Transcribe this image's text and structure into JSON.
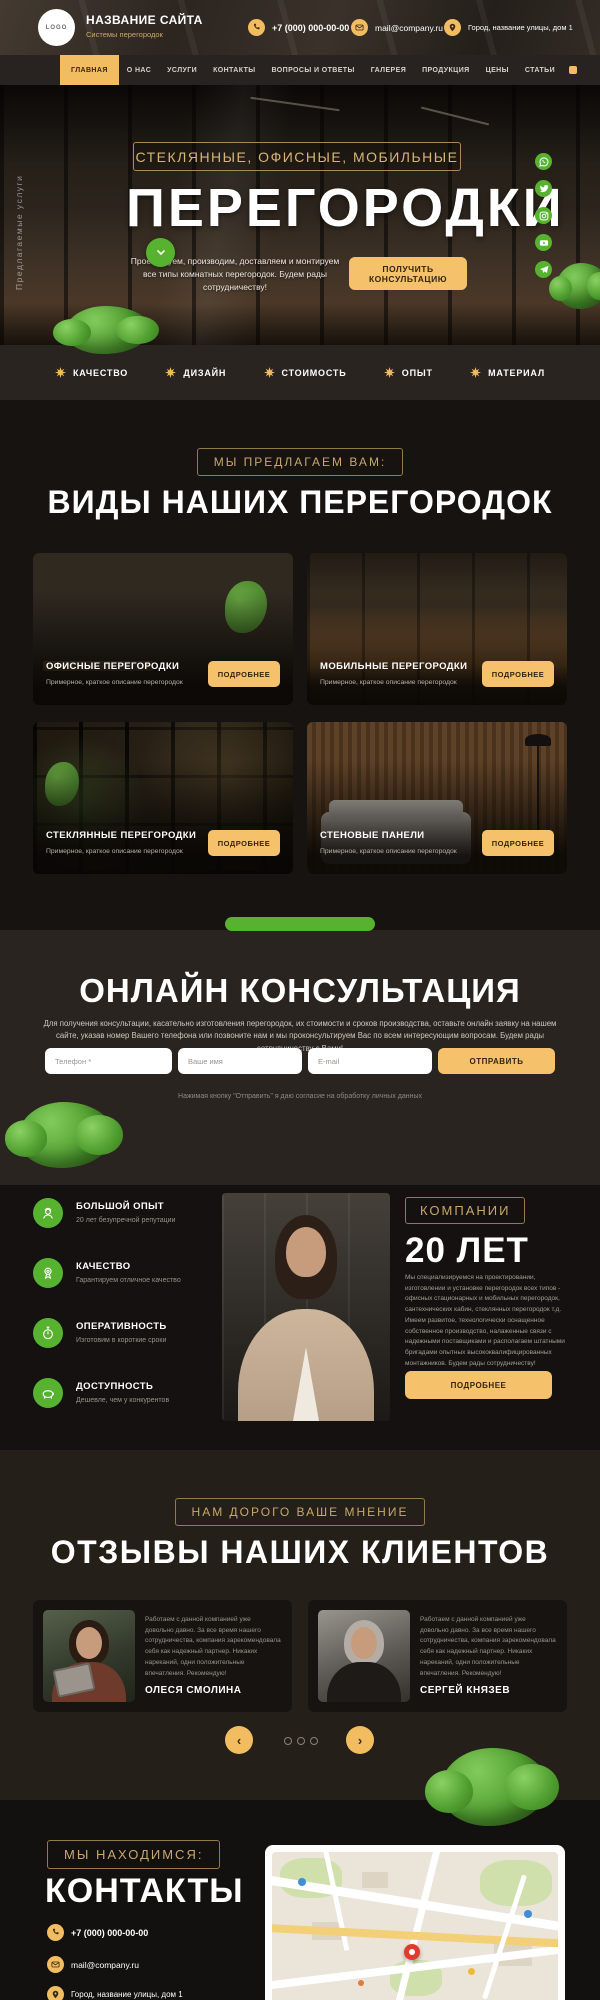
{
  "brand": {
    "logo_text": "LOGO",
    "name": "НАЗВАНИЕ САЙТА",
    "tagline": "Системы перегородок"
  },
  "header": {
    "phone": "+7 (000) 000-00-00",
    "email": "mail@company.ru",
    "address": "Город, название улицы, дом 1"
  },
  "nav": {
    "items": [
      {
        "label": "ГЛАВНАЯ"
      },
      {
        "label": "О НАС"
      },
      {
        "label": "УСЛУГИ"
      },
      {
        "label": "КОНТАКТЫ"
      },
      {
        "label": "ВОПРОСЫ И ОТВЕТЫ"
      },
      {
        "label": "ГАЛЕРЕЯ"
      },
      {
        "label": "ПРОДУКЦИЯ"
      },
      {
        "label": "ЦЕНЫ"
      },
      {
        "label": "СТАТЬИ"
      }
    ]
  },
  "hero": {
    "side_label": "Предлагаемые услуги",
    "kicker": "СТЕКЛЯННЫЕ, ОФИСНЫЕ, МОБИЛЬНЫЕ",
    "title": "ПЕРЕГОРОДКИ",
    "subtitle": "Проектируем, производим, доставляем и монтируем все типы комнатных перегородок. Будем рады сотрудничеству!",
    "cta": "ПОЛУЧИТЬ КОНСУЛЬТАЦИЮ",
    "socials": [
      "whatsapp",
      "twitter",
      "instagram",
      "youtube",
      "telegram"
    ]
  },
  "strip": {
    "items": [
      "КАЧЕСТВО",
      "ДИЗАЙН",
      "СТОИМОСТЬ",
      "ОПЫТ",
      "МАТЕРИАЛ"
    ]
  },
  "offer": {
    "badge": "МЫ ПРЕДЛАГАЕМ ВАМ:",
    "title": "ВИДЫ НАШИХ ПЕРЕГОРОДОК",
    "more_label": "ПОДРОБНЕЕ",
    "cards": [
      {
        "title": "ОФИСНЫЕ ПЕРЕГОРОДКИ",
        "desc": "Примерное, краткое описание перегородок"
      },
      {
        "title": "МОБИЛЬНЫЕ ПЕРЕГОРОДКИ",
        "desc": "Примерное, краткое описание перегородок"
      },
      {
        "title": "СТЕКЛЯННЫЕ ПЕРЕГОРОДКИ",
        "desc": "Примерное, краткое описание перегородок"
      },
      {
        "title": "СТЕНОВЫЕ ПАНЕЛИ",
        "desc": "Примерное, краткое описание перегородок"
      }
    ]
  },
  "consult": {
    "title": "ОНЛАЙН КОНСУЛЬТАЦИЯ",
    "text": "Для получения консультации, касательно изготовления перегородок, их стоимости и сроков производства, оставьте онлайн заявку на нашем сайте, указав номер Вашего телефона или позвоните нам и мы проконсультируем Вас по всем интересующим вопросам. Будем рады сотрудничеству с Вами!",
    "form": {
      "phone_placeholder": "Телефон *",
      "name_placeholder": "Ваше имя",
      "email_placeholder": "E-mail",
      "submit": "ОТПРАВИТЬ",
      "consent": "Нажимая кнопку \"Отправить\" я даю согласие на обработку личных данных"
    }
  },
  "company": {
    "features": [
      {
        "title": "БОЛЬШОЙ ОПЫТ",
        "desc": "20 лет безупречной репутации"
      },
      {
        "title": "КАЧЕСТВО",
        "desc": "Гарантируем отличное качество"
      },
      {
        "title": "ОПЕРАТИВНОСТЬ",
        "desc": "Изготовим в короткие сроки"
      },
      {
        "title": "ДОСТУПНОСТЬ",
        "desc": "Дешевле, чем у конкурентов"
      }
    ],
    "badge": "КОМПАНИИ",
    "title": "20 ЛЕТ",
    "text": "Мы специализируемся на проектировании, изготовлении и установке перегородок всех типов - офисных стационарных и мобильных перегородок, сантехнических кабин, стеклянных перегородок т.д. Имеем развитое, технологически оснащенное собственное производство, налаженные связи с надежными поставщиками и располагаем штатными бригадами опытных высококвалифицированных монтажников. Будем рады сотрудничеству!",
    "button": "ПОДРОБНЕЕ"
  },
  "reviews": {
    "badge": "НАМ ДОРОГО ВАШЕ МНЕНИЕ",
    "title": "ОТЗЫВЫ НАШИХ КЛИЕНТОВ",
    "items": [
      {
        "text": "Работаем с данной компанией уже довольно давно. За все время нашего сотрудничества, компания зарекомендовала себя как надежный партнер. Никаких нареканий, одни положительные впечатления. Рекомендую!",
        "name": "ОЛЕСЯ СМОЛИНА"
      },
      {
        "text": "Работаем с данной компанией уже довольно давно. За все время нашего сотрудничества, компания зарекомендовала себя как надежный партнер. Никаких нареканий, одни положительные впечатления. Рекомендую!",
        "name": "СЕРГЕЙ КНЯЗЕВ"
      }
    ]
  },
  "contacts": {
    "badge": "МЫ НАХОДИМСЯ:",
    "title": "КОНТАКТЫ",
    "phone": "+7 (000) 000-00-00",
    "email": "mail@company.ru",
    "address": "Город, название улицы, дом 1"
  },
  "colors": {
    "accent": "#f2bd60",
    "gold": "#c9a76b",
    "green": "#57b32f"
  }
}
